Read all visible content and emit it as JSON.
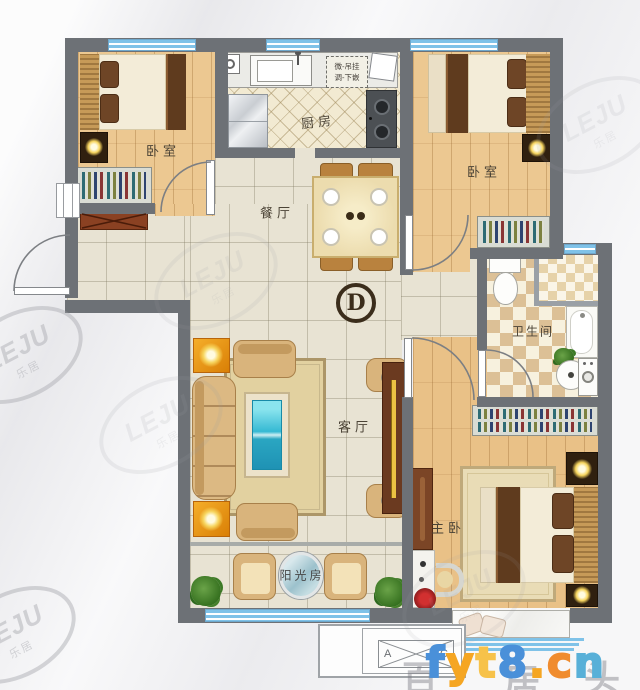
{
  "rooms": {
    "bedroom_left": "卧室",
    "bedroom_right": "卧室",
    "kitchen": "厨房",
    "dining_room": "餐厅",
    "living_room": "客厅",
    "bathroom": "卫生间",
    "master_bedroom": "主卧",
    "sunroom": "阳光房"
  },
  "annotations": {
    "unit_label": "D",
    "kitchen_note_line1": "微-吊挂",
    "kitchen_note_line2": "调-下嵌",
    "ac_platform_left": "A",
    "ac_platform_right": "C"
  },
  "watermarks": {
    "logo_text": "LEJU",
    "logo_cn": "乐居",
    "site": "fyt8.cn",
    "site_letters": [
      {
        "ch": "f",
        "color": "#4a90d9"
      },
      {
        "ch": "y",
        "color": "#f5a623"
      },
      {
        "ch": "t",
        "color": "#f7c24a"
      },
      {
        "ch": "8",
        "color": "#4a90d9"
      },
      {
        "ch": ".",
        "color": "#f5a623"
      },
      {
        "ch": "c",
        "color": "#f08c2e"
      },
      {
        "ch": "n",
        "color": "#58b0d8"
      }
    ],
    "faint_chars": [
      "百",
      "居",
      "头"
    ]
  },
  "colors": {
    "wall": "#6d7176",
    "window_blue": "#7fc2e8",
    "wood_floor": "#ecc891",
    "tile_floor": "#e8e3d3",
    "accent_orange": "#f29c10",
    "coffee_table_teal": "#2db3cc"
  }
}
